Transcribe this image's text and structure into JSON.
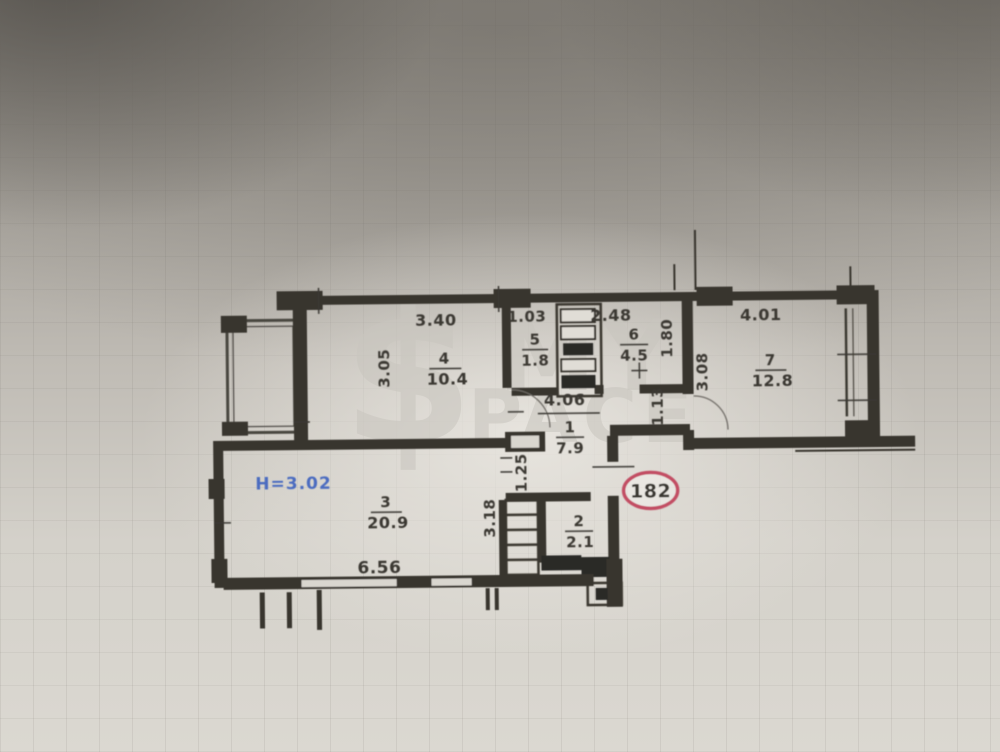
{
  "plan": {
    "apartment_badge": "182",
    "ceiling_height": "H=3.02",
    "rooms": [
      {
        "num": "1",
        "area": "7.9"
      },
      {
        "num": "2",
        "area": "2.1"
      },
      {
        "num": "3",
        "area": "20.9"
      },
      {
        "num": "4",
        "area": "10.4"
      },
      {
        "num": "5",
        "area": "1.8"
      },
      {
        "num": "6",
        "area": "4.5"
      },
      {
        "num": "7",
        "area": "12.8"
      }
    ],
    "dims": {
      "d340": "3.40",
      "d103": "1.03",
      "d248": "2.48",
      "d401": "4.01",
      "d305": "3.05",
      "d180": "1.80",
      "d308": "3.08",
      "d113": "1.13",
      "d406": "4.06",
      "d125": "1.25",
      "d318": "3.18",
      "d656": "6.56"
    }
  },
  "watermark": {
    "symbol": "$",
    "line1": "MY",
    "line2": "PACE"
  },
  "colors": {
    "wall": "#38352f",
    "label": "#3a3733",
    "height_blue": "#4b6cc0",
    "badge_red": "#c24e63",
    "watermark_gray": "#c9c6bf"
  }
}
